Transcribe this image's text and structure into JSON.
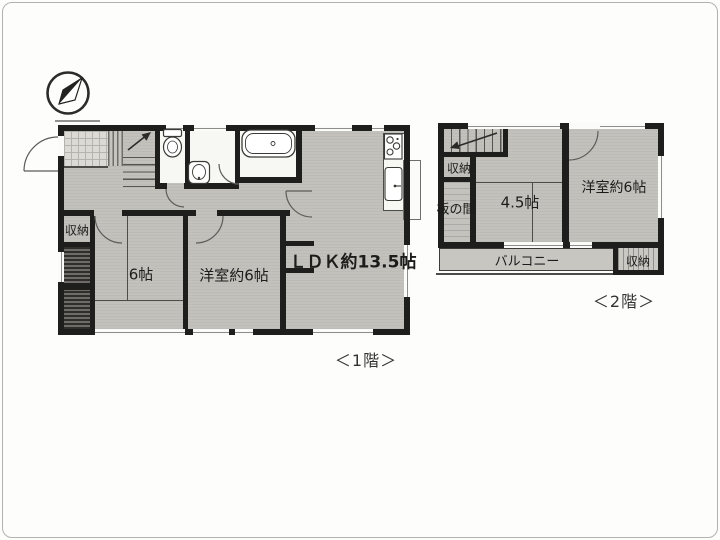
{
  "floor1": {
    "caption": "＜1階＞",
    "labels": {
      "storage": "収納",
      "tatami_room": "6帖",
      "western_room": "洋室約6帖",
      "ldk": "ＬＤＫ約13.5帖"
    },
    "fixtures": [
      "compass-icon",
      "toilet-icon",
      "washbasin-icon",
      "bathtub-icon",
      "stove-icon",
      "kitchen-sink-icon",
      "staircase-up"
    ]
  },
  "floor2": {
    "caption": "＜2階＞",
    "labels": {
      "storage_upper": "収納",
      "itanoma": "板の間",
      "tatami_room": "4.5帖",
      "western_room": "洋室約6帖",
      "balcony": "バルコニー",
      "storage_lower": "収納"
    },
    "fixtures": [
      "staircase-down"
    ]
  },
  "colors": {
    "wall": "#1e1e1c",
    "room_fill": "#c2c1bc",
    "tile_fill": "#dbdad5",
    "white_room": "#f7f7f4",
    "dark_closet": "#55544f",
    "scan_border": "#b3b2b0"
  }
}
